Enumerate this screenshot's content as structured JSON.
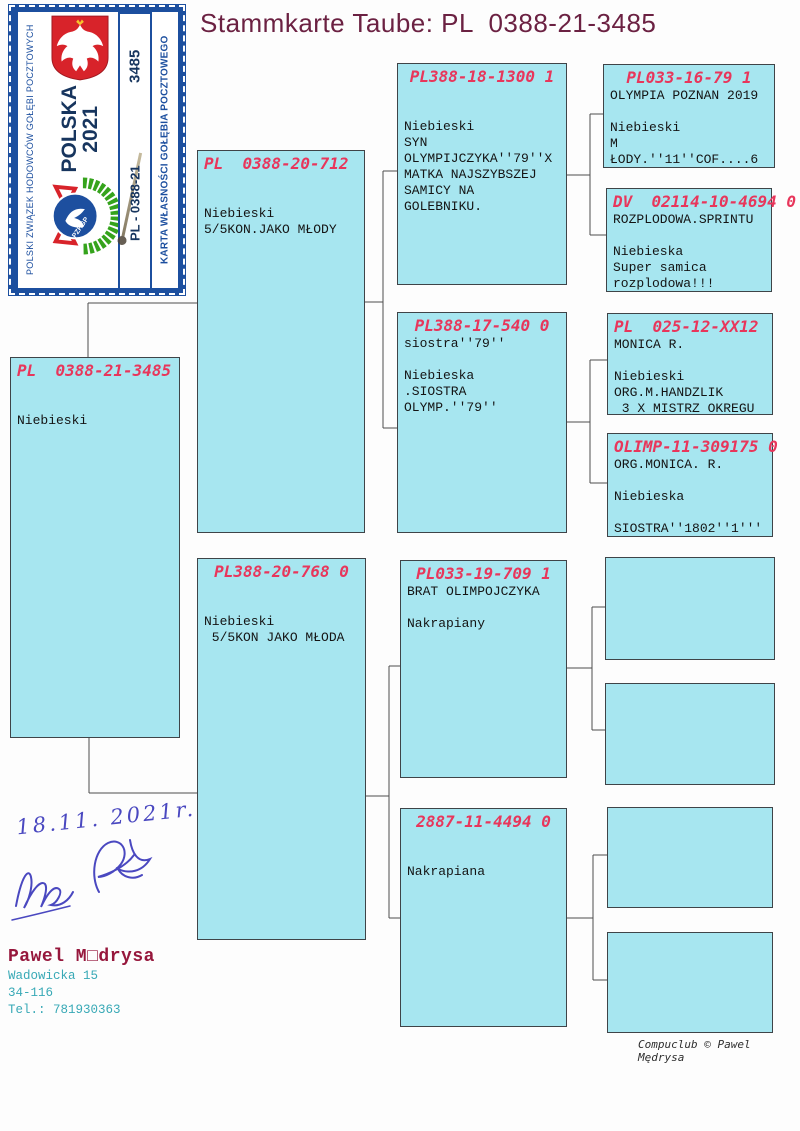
{
  "title": "Stammkarte Taube: PL  0388-21-3485",
  "stamp": {
    "left_text": "POLSKI ZWIĄZEK HODOWCÓW GOŁĘBI POCZTOWYCH",
    "right_text": "KARTA WŁASNOŚCI GOŁĘBIA POCZTOWEGO",
    "country": "POLSKA",
    "year": "2021",
    "serial": "3485",
    "ring": "PL - 0388-21",
    "logo_abbr": "PZHGP"
  },
  "pedigree": {
    "subject": {
      "code": "PL  0388-21-3485",
      "body": "\n\nNiebieski"
    },
    "father": {
      "code": "PL  0388-20-712",
      "body": "\n\nNiebieski\n5/5KON.JAKO MŁODY"
    },
    "mother": {
      "code": "PL388-20-768 0",
      "body": "\n\nNiebieski\n 5/5KON JAKO MŁODA"
    },
    "ff": {
      "code": "PL388-18-1300 1",
      "body": "\n\nNiebieski\nSYN\nOLYMPIJCZYKA''79''X\nMATKA NAJSZYBSZEJ\nSAMICY NA\nGOLEBNIKU."
    },
    "fm": {
      "code": "PL388-17-540 0",
      "body": "siostra''79''\n\nNiebieska\n.SIOSTRA\nOLYMP.''79''"
    },
    "mf": {
      "code": "PL033-19-709 1",
      "body": "BRAT OLIMPOJCZYKA\n\nNakrapiany"
    },
    "mm": {
      "code": "2887-11-4494 0",
      "body": "\n\nNakrapiana"
    },
    "fff": {
      "code": "PL033-16-79 1",
      "body": "OLYMPIA POZNAN 2019\n\nNiebieski\nM\nŁODY.''11''COF....6"
    },
    "ffm": {
      "code": "DV  02114-10-4694 0",
      "body": "ROZPLODOWA.SPRINTU\n\nNiebieska\nSuper samica\nrozplodowa!!!"
    },
    "fmf": {
      "code": "PL  025-12-XX12",
      "body": "MONICA R.\n\nNiebieski\nORG.M.HANDZLIK\n 3 X MISTRZ OKREGU"
    },
    "fmm": {
      "code": "OLIMP-11-309175 0",
      "body": "ORG.MONICA. R.\n\nNiebieska\n\nSIOSTRA''1802''1'''"
    }
  },
  "handwriting": {
    "date": "18.11. 2021r."
  },
  "owner": {
    "name": "Pawel M□drysa",
    "street": "Wadowicka 15",
    "postal": "34-116",
    "phone": "Tel.: 781930363"
  },
  "footer": {
    "credit": "Compuclub © Pawel Mędrysa"
  },
  "colors": {
    "box_fill": "#a7e6f0",
    "header_red": "#e8365b",
    "title_maroon": "#6b2142",
    "stamp_blue": "#1c4f9f",
    "owner_maroon": "#96173c",
    "address_teal": "#38a9b6",
    "eagle_red": "#d8232a",
    "wreath_green": "#35a31c"
  }
}
